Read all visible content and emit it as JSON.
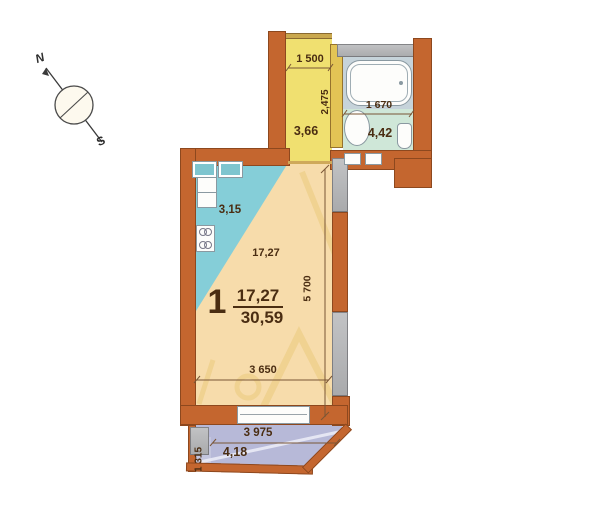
{
  "compass": {
    "north": "N",
    "south": "S"
  },
  "rooms": {
    "hallway": {
      "area": "3,66",
      "width": "1 500",
      "depth": "2,475"
    },
    "bathroom": {
      "area": "4,42",
      "width": "1 670"
    },
    "kitchen": {
      "area": "3,15"
    },
    "room": {
      "number": "1",
      "area_label": "17,27",
      "living_area": "17,27",
      "total_area": "30,59",
      "length": "5 700",
      "width": "3 650"
    },
    "balcony": {
      "area": "4,18",
      "width": "3 975",
      "depth": "1 315"
    }
  },
  "colors": {
    "brick_wall": "#c4662f",
    "concrete_wall": "#b6b7b9",
    "partition_wall": "#e3c455",
    "hallway_floor": "#f0e070",
    "bathroom_floor": "#cfe7d8",
    "bath_niche": "#c6d3da",
    "kitchen_zone": "#85ced8",
    "room_floor": "#f7dcab",
    "balcony_floor": "#b7b9d8",
    "dimension_text": "#4a2d12",
    "watermark": "#e8c46e"
  }
}
